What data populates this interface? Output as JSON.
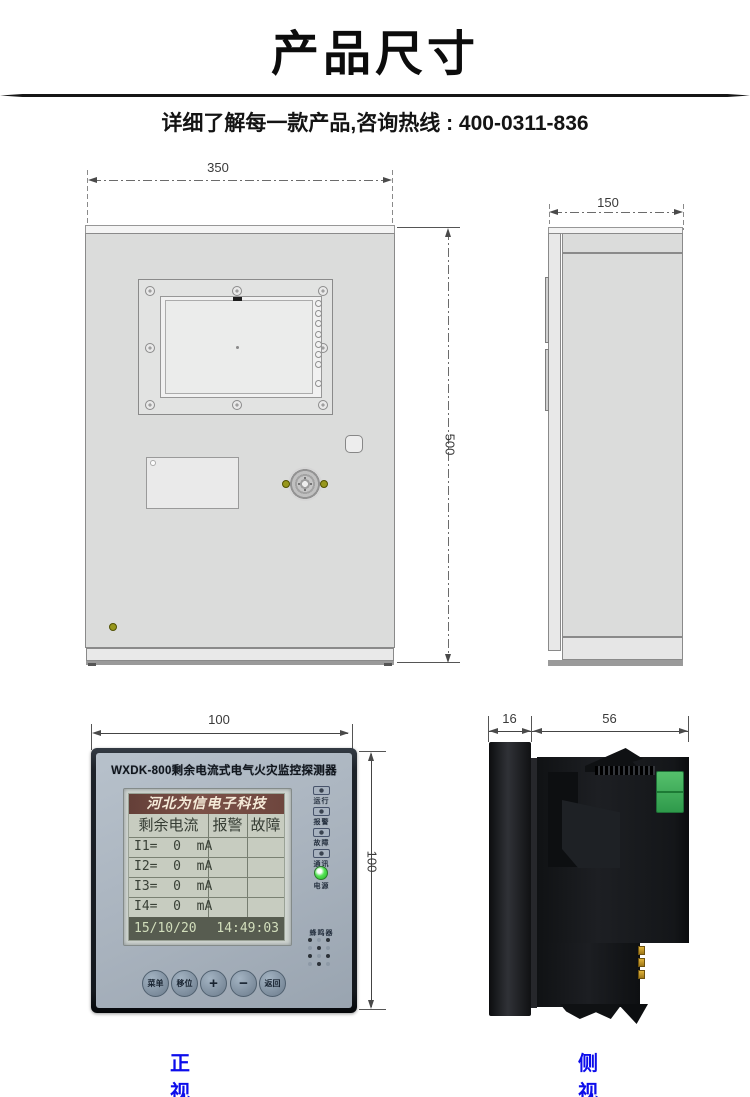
{
  "page": {
    "title": "产品尺寸",
    "subtitle": "详细了解每一款产品,咨询热线 : 400-0311-836"
  },
  "colors": {
    "caption_blue": "#0d0deb",
    "cabinet_gray": "#dbdcdb",
    "device_face": "#aab4bf",
    "lcd_bg": "#c7ccc0",
    "lcd_header_maroon": "#6e463e",
    "lcd_footer_olive": "#575c50",
    "led_green": "#3ee63e",
    "terminal_green": "#3fae58"
  },
  "cabinet": {
    "front": {
      "width_dim": "350",
      "height_dim": "500"
    },
    "side": {
      "depth_dim": "150"
    }
  },
  "device": {
    "front": {
      "width_dim": "100",
      "height_dim": "100",
      "title": "WXDK-800剩余电流式电气火灾监控探测器",
      "lcd": {
        "brand": "河北为信电子科技",
        "headers": [
          "剩余电流",
          "报警",
          "故障"
        ],
        "rows": [
          "I1=  0  mA",
          "I2=  0  mA",
          "I3=  0  mA",
          "I4=  0  mA"
        ],
        "date": "15/10/20",
        "time": "14:49:03"
      },
      "leds": [
        {
          "label": "运行",
          "lit": false
        },
        {
          "label": "报警",
          "lit": false
        },
        {
          "label": "故障",
          "lit": false
        },
        {
          "label": "通讯",
          "lit": false
        },
        {
          "label": "电源",
          "lit": true
        }
      ],
      "buzzer_label": "蜂鸣器",
      "buttons": [
        "菜单",
        "移位",
        "+",
        "−",
        "返回"
      ],
      "caption": "正视图"
    },
    "side": {
      "bezel_dim": "16",
      "body_dim": "56",
      "caption": "侧视图"
    }
  }
}
